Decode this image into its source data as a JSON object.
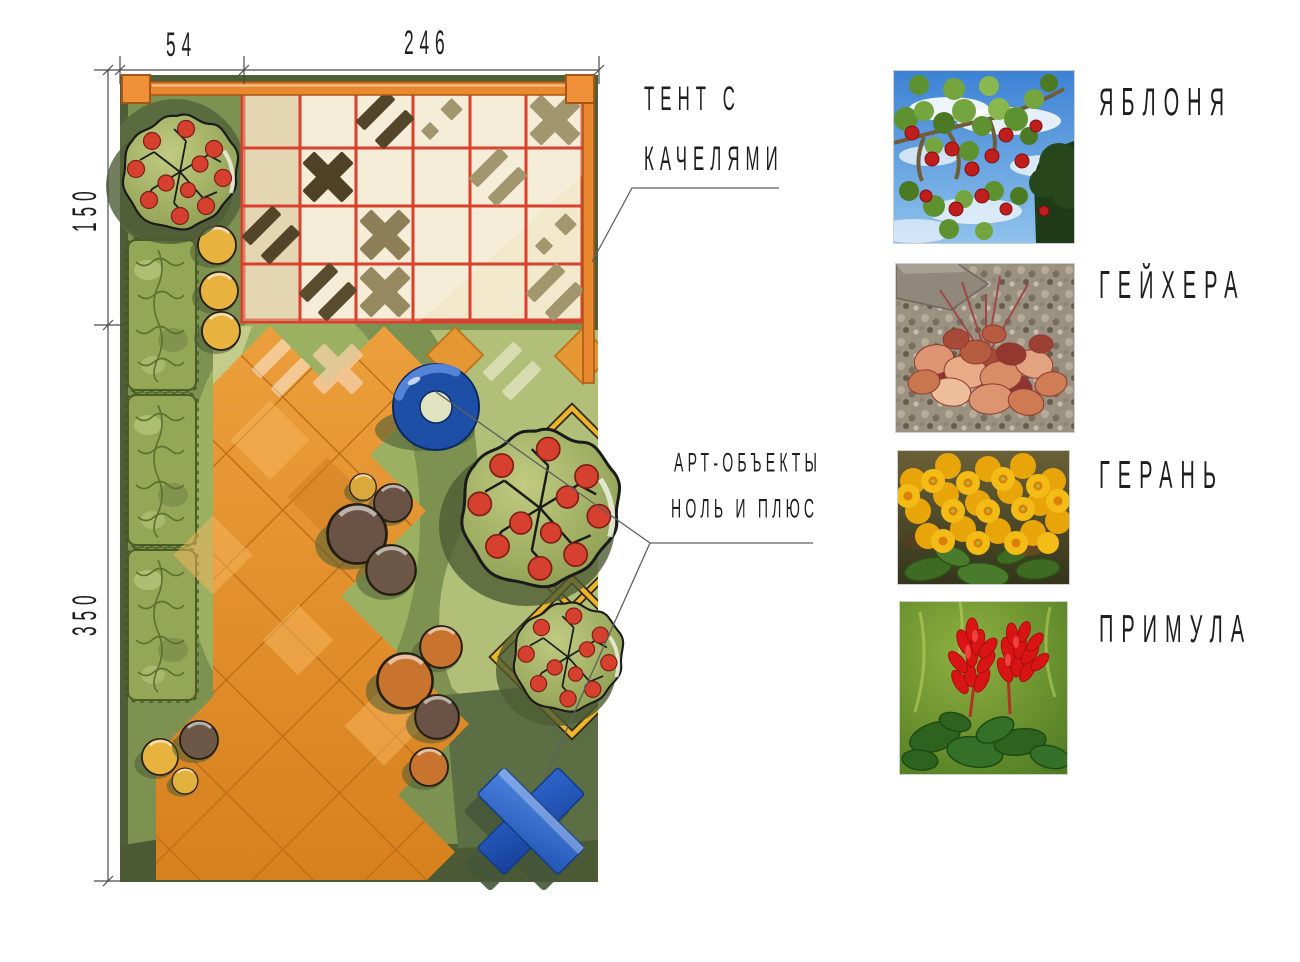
{
  "plan": {
    "dimensions": {
      "top_left": "54",
      "top_right": "246",
      "side_upper": "150",
      "side_lower": "350"
    },
    "annotations": {
      "tent_line1": "ТЕНТ С",
      "tent_line2": "КАЧЕЛЯМИ",
      "art_line1": "АРТ-ОБЪЕКТЫ",
      "art_line2": "НОЛЬ И ПЛЮС"
    },
    "colors": {
      "paving_orange": "#e0912f",
      "canopy_grid_red": "#d9402e",
      "art_object_blue": "#2058b8",
      "lawn_green": "#7d9150",
      "border_green": "#4e5f37",
      "pergola_orange": "#ea8830"
    }
  },
  "legend": {
    "items": [
      {
        "label": "ЯБЛОНЯ",
        "photo": "apple-tree"
      },
      {
        "label": "ГЕЙХЕРА",
        "photo": "heuchera"
      },
      {
        "label": "ГЕРАНЬ",
        "photo": "geranium"
      },
      {
        "label": "ПРИМУЛА",
        "photo": "primula"
      }
    ]
  }
}
